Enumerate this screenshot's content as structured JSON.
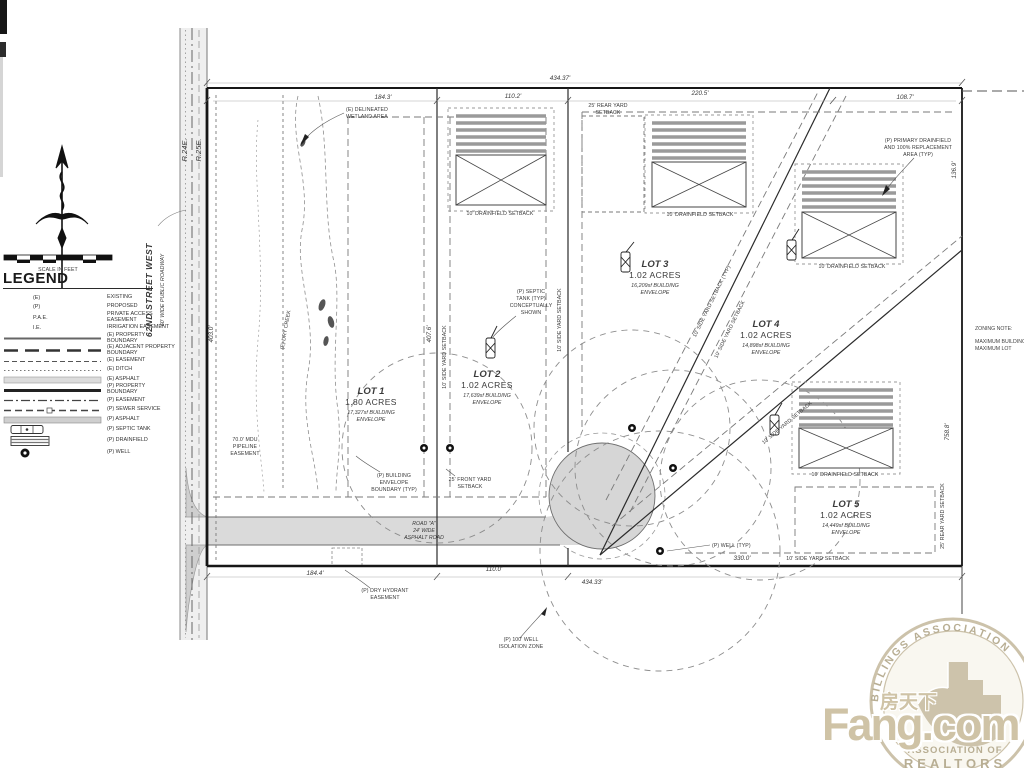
{
  "legend": {
    "title": "LEGEND",
    "scale_label": "SCALE IN FEET",
    "entries": [
      {
        "symbol": "(E)",
        "label": "EXISTING",
        "icon": "abbr"
      },
      {
        "symbol": "(P)",
        "label": "PROPOSED",
        "icon": "abbr"
      },
      {
        "symbol": "P.A.E.",
        "label": "PRIVATE ACCESS EASEMENT",
        "icon": "abbr"
      },
      {
        "symbol": "I.E.",
        "label": "IRRIGATION EASEMENT",
        "icon": "abbr"
      },
      {
        "symbol": "",
        "label": "(E) PROPERTY BOUNDARY",
        "icon": "solid-line"
      },
      {
        "symbol": "",
        "label": "(E) ADJACENT PROPERTY BOUNDARY",
        "icon": "long-dash-line"
      },
      {
        "symbol": "",
        "label": "(E) EASEMENT",
        "icon": "dash-line"
      },
      {
        "symbol": "",
        "label": "(E) DITCH",
        "icon": "dot-line"
      },
      {
        "symbol": "",
        "label": "(E) ASPHALT",
        "icon": "asphalt-swatch"
      },
      {
        "symbol": "",
        "label": "(P) PROPERTY BOUNDARY",
        "icon": "heavy-line"
      },
      {
        "symbol": "",
        "label": "(P) EASEMENT",
        "icon": "dash-dot-line"
      },
      {
        "symbol": "",
        "label": "(P) SEWER SERVICE",
        "icon": "sewer-line"
      },
      {
        "symbol": "",
        "label": "(P) ASPHALT",
        "icon": "asphalt-swatch"
      },
      {
        "symbol": "",
        "label": "(P) SEPTIC TANK",
        "icon": "septic-tank-icon"
      },
      {
        "symbol": "",
        "label": "(P) DRAINFIELD",
        "icon": "drainfield-icon"
      },
      {
        "symbol": "",
        "label": "(P) WELL",
        "icon": "well-icon"
      }
    ]
  },
  "streets": {
    "name": "62ND STREET WEST",
    "type": "60' WIDE PUBLIC ROADWAY",
    "range_west": "R.24E.",
    "range_east": "R.25E."
  },
  "lots": [
    {
      "name": "LOT 1",
      "area": "1.80 ACRES",
      "env1": "17,327sf BUILDING",
      "env2": "ENVELOPE"
    },
    {
      "name": "LOT 2",
      "area": "1.02 ACRES",
      "env1": "17,639sf BUILDING",
      "env2": "ENVELOPE"
    },
    {
      "name": "LOT 3",
      "area": "1.02 ACRES",
      "env1": "16,209sf BUILDING",
      "env2": "ENVELOPE"
    },
    {
      "name": "LOT 4",
      "area": "1.02 ACRES",
      "env1": "14,898sf BUILDING",
      "env2": "ENVELOPE"
    },
    {
      "name": "LOT 5",
      "area": "1.02 ACRES",
      "env1": "14,449sf BUILDING",
      "env2": "ENVELOPE"
    }
  ],
  "dims": {
    "top_overall": "434.37'",
    "top1": "184.3'",
    "top2": "110.2'",
    "top3": "220.5'",
    "top4": "108.7'",
    "left_side": "403.0'",
    "lot12_line": "407.6'",
    "right_top": "136.9'",
    "right_side": "758.8'",
    "bottom1": "184.4'",
    "bottom2": "110.0'",
    "bottom_overall": "434.33'",
    "bottom3": "330.0'"
  },
  "annotations": {
    "wetland": [
      "(E) DELINEATED",
      "WETLAND AREA"
    ],
    "dry_creek": "(E) DRY CREEK",
    "rear_setback": [
      "25' REAR YARD",
      "SETBACK"
    ],
    "rear_setback_rot": "25' REAR YARD SETBACK",
    "drainfield_setback": "10' DRAINFIELD SETBACK",
    "primary_drainfield": [
      "(P) PRIMARY DRAINFIELD",
      "AND 100% REPLACEMENT",
      "AREA (TYP)"
    ],
    "septic": [
      "(P) SEPTIC",
      "TANK (TYP)",
      "CONCEPTUALLY",
      "SHOWN"
    ],
    "front_setback": [
      "25' FRONT YARD",
      "SETBACK"
    ],
    "bldg_env": [
      "(P) BUILDING",
      "ENVELOPE",
      "BOUNDARY (TYP)"
    ],
    "mdu": [
      "70.0' MDU",
      "PIPELINE",
      "EASEMENT"
    ],
    "dry_hydrant": [
      "(P) DRY HYDRANT",
      "EASEMENT"
    ],
    "well_iso": [
      "(P) 100' WELL",
      "ISOLATION ZONE"
    ],
    "well_typ": "(P) WELL (TYP)",
    "side_setback": "10' SIDE YARD SETBACK",
    "side_setback_typ": "10' SIDE YARD SETBACK (TYP)",
    "road": [
      "ROAD \"A\"",
      "24' WIDE",
      "ASPHALT ROAD"
    ]
  },
  "zoning_note": {
    "title": "ZONING NOTE:",
    "line1": "MAXIMUM BUILDING",
    "line2": "MAXIMUM LOT"
  },
  "watermark": {
    "arc_text": "BILLINGS ASSOCIATION",
    "assoc1": "ASSOCIATION OF",
    "assoc2": "REALTORS",
    "cn": "房天下",
    "domain": "Fang.com",
    "tan": "#cfc3a6"
  }
}
